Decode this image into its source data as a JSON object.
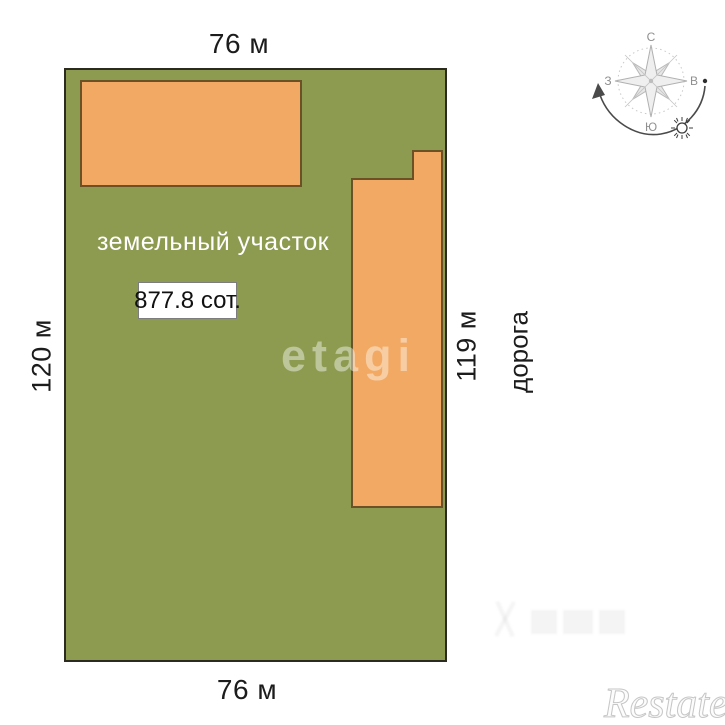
{
  "plot": {
    "label": "земельный участок",
    "area": "877.8 сот.",
    "dim_top": "76 м",
    "dim_bottom": "76 м",
    "dim_left": "120 м",
    "dim_right": "119 м",
    "road": "дорога",
    "fill_color": "#8d9b51",
    "border_color": "#2b2b22"
  },
  "buildings": {
    "fill_color": "#f2a963",
    "border_color": "#6a5226"
  },
  "compass": {
    "north": "С",
    "east": "В",
    "south": "Ю",
    "west": "З"
  },
  "watermarks": {
    "center": "etagi",
    "bottom_right": "Restate"
  }
}
